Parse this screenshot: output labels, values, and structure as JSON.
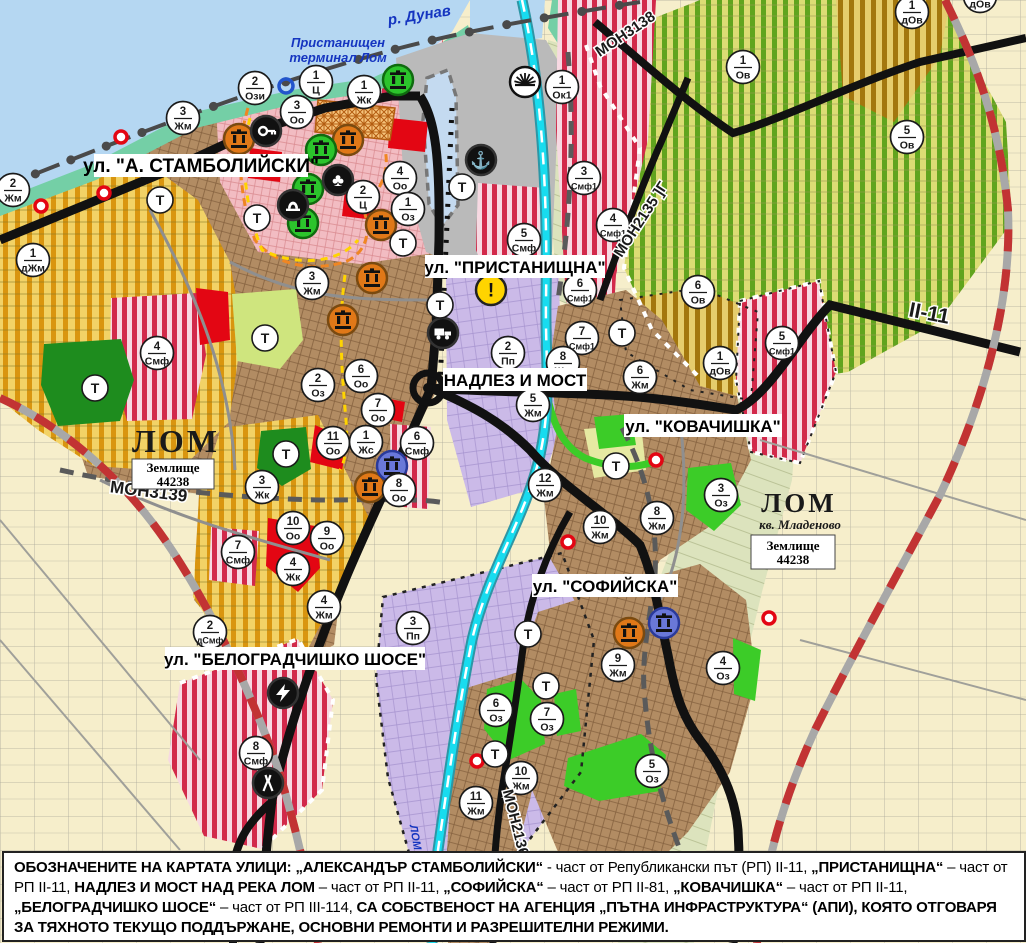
{
  "colors": {
    "water": "#b5d7f2",
    "shore_green": "#74cfa6",
    "port_gray": "#bababa",
    "harbor": "#c4daf0",
    "marker_bg": "#ffffff",
    "marker_ink": "#1a1a1a",
    "orange_icon": "#e07818",
    "green_icon": "#2cc42c",
    "blue_icon": "#6a78d8",
    "black_icon": "#111111",
    "warn_yellow": "#ffd400",
    "red_dot": "#e30613",
    "river_cyan": "#18dcef",
    "road_black": "#111111",
    "rail_red": "#c23333",
    "label_blue": "#1535c0"
  },
  "water_labels": [
    {
      "text": "р. Дунав",
      "x": 420,
      "y": 20,
      "rot": -9,
      "fs": 15
    },
    {
      "text": "Пристанищен",
      "x": 338,
      "y": 47,
      "rot": 0,
      "fs": 13
    },
    {
      "text": "терминал Лом",
      "x": 338,
      "y": 62,
      "rot": 0,
      "fs": 13
    },
    {
      "text": "ЛОМ",
      "x": 412,
      "y": 838,
      "rot": 80,
      "fs": 11
    }
  ],
  "street_labels": [
    {
      "text": "ул. \"А. СТАМБОЛИЙСКИ\"",
      "x": 201,
      "y": 166,
      "w": 214,
      "fs": 19
    },
    {
      "text": "ул. \"ПРИСТАНИЩНА\"",
      "x": 515,
      "y": 267,
      "w": 180,
      "fs": 17
    },
    {
      "text": "НАДЛЕЗ И МОСТ",
      "x": 515,
      "y": 380,
      "w": 144,
      "fs": 17
    },
    {
      "text": "ул. \"КОВАЧИШКА\"",
      "x": 703,
      "y": 426,
      "w": 158,
      "fs": 17
    },
    {
      "text": "ул. \"СОФИЙСКА\"",
      "x": 605,
      "y": 586,
      "w": 146,
      "fs": 17
    },
    {
      "text": "ул. \"БЕЛОГРАДЧИШКО ШОСЕ\"",
      "x": 295,
      "y": 659,
      "w": 260,
      "fs": 17
    }
  ],
  "road_labels": [
    {
      "text": "МОН3139",
      "x": 148,
      "y": 497,
      "rot": 7,
      "fs": 17
    },
    {
      "text": "МОН3138",
      "x": 628,
      "y": 38,
      "rot": -34,
      "fs": 15
    },
    {
      "text": "МОН2135 ]Г",
      "x": 645,
      "y": 222,
      "rot": -57,
      "fs": 15
    },
    {
      "text": "II-11",
      "x": 928,
      "y": 320,
      "rot": 11,
      "fs": 21
    },
    {
      "text": "МОН2136",
      "x": 511,
      "y": 824,
      "rot": 76,
      "fs": 15
    }
  ],
  "place_labels": {
    "lom1": {
      "text": "ЛОМ",
      "x": 176,
      "y": 452,
      "fs": 32
    },
    "lom2": {
      "text": "ЛОМ",
      "x": 799,
      "y": 512,
      "fs": 27
    },
    "mladenovo": {
      "text": "кв. Младеново",
      "x": 800,
      "y": 529,
      "fs": 13
    },
    "zem1": {
      "line1": "Землище",
      "line2": "44238",
      "x": 173,
      "y": 474,
      "w": 82,
      "h": 30
    },
    "zem2": {
      "line1": "Землище",
      "line2": "44238",
      "x": 793,
      "y": 552,
      "w": 84,
      "h": 34
    }
  },
  "zone_markers": [
    {
      "n": "2",
      "c": "Жм",
      "x": 13,
      "y": 190
    },
    {
      "n": "3",
      "c": "Жм",
      "x": 183,
      "y": 118
    },
    {
      "n": "2",
      "c": "Ози",
      "x": 255,
      "y": 88
    },
    {
      "n": "1",
      "c": "Ц",
      "x": 316,
      "y": 82
    },
    {
      "n": "1",
      "c": "Жк",
      "x": 364,
      "y": 92
    },
    {
      "n": "3",
      "c": "Оо",
      "x": 297,
      "y": 112
    },
    {
      "n": "4",
      "c": "Оо",
      "x": 400,
      "y": 178
    },
    {
      "n": "2",
      "c": "Ц",
      "x": 363,
      "y": 197
    },
    {
      "n": "1",
      "c": "Оз",
      "x": 408,
      "y": 209
    },
    {
      "n": "1",
      "c": "Ок1",
      "x": 562,
      "y": 87
    },
    {
      "n": "3",
      "c": "Смф1",
      "x": 584,
      "y": 178
    },
    {
      "n": "4",
      "c": "Смф1",
      "x": 613,
      "y": 225
    },
    {
      "n": "5",
      "c": "Смф",
      "x": 524,
      "y": 240
    },
    {
      "n": "1",
      "c": "Ов",
      "x": 743,
      "y": 67
    },
    {
      "n": "5",
      "c": "Ов",
      "x": 907,
      "y": 137
    },
    {
      "n": "1",
      "c": "дОв",
      "x": 912,
      "y": 12
    },
    {
      "n": "1",
      "c": "дОв",
      "x": 980,
      "y": -4
    },
    {
      "n": "6",
      "c": "Ов",
      "x": 698,
      "y": 292
    },
    {
      "n": "1",
      "c": "дОв",
      "x": 720,
      "y": 363
    },
    {
      "n": "5",
      "c": "Смф1",
      "x": 782,
      "y": 343
    },
    {
      "n": "6",
      "c": "Смф1",
      "x": 580,
      "y": 290
    },
    {
      "n": "7",
      "c": "Смф1",
      "x": 582,
      "y": 338
    },
    {
      "n": "1",
      "c": "дЖм",
      "x": 33,
      "y": 260
    },
    {
      "n": "3",
      "c": "Жм",
      "x": 312,
      "y": 283
    },
    {
      "n": "4",
      "c": "Смф",
      "x": 157,
      "y": 353
    },
    {
      "n": "2",
      "c": "Оз",
      "x": 318,
      "y": 385
    },
    {
      "n": "6",
      "c": "Оо",
      "x": 361,
      "y": 376
    },
    {
      "n": "7",
      "c": "Оо",
      "x": 378,
      "y": 410
    },
    {
      "n": "11",
      "c": "Оо",
      "x": 333,
      "y": 443
    },
    {
      "n": "1",
      "c": "Жс",
      "x": 366,
      "y": 442
    },
    {
      "n": "6",
      "c": "Смф",
      "x": 417,
      "y": 443
    },
    {
      "n": "8",
      "c": "Оо",
      "x": 399,
      "y": 490
    },
    {
      "n": "3",
      "c": "Жк",
      "x": 262,
      "y": 487
    },
    {
      "n": "2",
      "c": "Пп",
      "x": 508,
      "y": 353
    },
    {
      "n": "8",
      "c": "Жм",
      "x": 563,
      "y": 363
    },
    {
      "n": "5",
      "c": "Жм",
      "x": 533,
      "y": 405
    },
    {
      "n": "6",
      "c": "Жм",
      "x": 640,
      "y": 377
    },
    {
      "n": "12",
      "c": "Жм",
      "x": 545,
      "y": 485
    },
    {
      "n": "10",
      "c": "Жм",
      "x": 600,
      "y": 527
    },
    {
      "n": "8",
      "c": "Жм",
      "x": 657,
      "y": 518
    },
    {
      "n": "3",
      "c": "Оз",
      "x": 721,
      "y": 495
    },
    {
      "n": "10",
      "c": "Оо",
      "x": 293,
      "y": 528
    },
    {
      "n": "9",
      "c": "Оо",
      "x": 327,
      "y": 538
    },
    {
      "n": "4",
      "c": "Жк",
      "x": 293,
      "y": 569
    },
    {
      "n": "4",
      "c": "Жм",
      "x": 324,
      "y": 607
    },
    {
      "n": "7",
      "c": "Смф",
      "x": 238,
      "y": 552
    },
    {
      "n": "2",
      "c": "дСмф",
      "x": 210,
      "y": 632
    },
    {
      "n": "3",
      "c": "Пп",
      "x": 413,
      "y": 628
    },
    {
      "n": "8",
      "c": "Смф",
      "x": 256,
      "y": 753
    },
    {
      "n": "9",
      "c": "Жм",
      "x": 618,
      "y": 665
    },
    {
      "n": "4",
      "c": "Оз",
      "x": 723,
      "y": 668
    },
    {
      "n": "6",
      "c": "Оз",
      "x": 496,
      "y": 710
    },
    {
      "n": "7",
      "c": "Оз",
      "x": 547,
      "y": 719
    },
    {
      "n": "5",
      "c": "Оз",
      "x": 652,
      "y": 771
    },
    {
      "n": "10",
      "c": "Жм",
      "x": 521,
      "y": 778
    },
    {
      "n": "11",
      "c": "Жм",
      "x": 476,
      "y": 803
    }
  ],
  "t_markers": [
    {
      "x": 160,
      "y": 200
    },
    {
      "x": 257,
      "y": 218
    },
    {
      "x": 462,
      "y": 187
    },
    {
      "x": 403,
      "y": 243
    },
    {
      "x": 440,
      "y": 305
    },
    {
      "x": 265,
      "y": 338
    },
    {
      "x": 95,
      "y": 388
    },
    {
      "x": 286,
      "y": 454
    },
    {
      "x": 622,
      "y": 333
    },
    {
      "x": 616,
      "y": 466
    },
    {
      "x": 528,
      "y": 634
    },
    {
      "x": 546,
      "y": 686
    },
    {
      "x": 495,
      "y": 754
    }
  ],
  "icons": [
    {
      "t": "monument-orange-icon",
      "x": 239,
      "y": 139
    },
    {
      "t": "monument-orange-icon",
      "x": 348,
      "y": 140
    },
    {
      "t": "monument-orange-icon",
      "x": 381,
      "y": 225
    },
    {
      "t": "monument-orange-icon",
      "x": 372,
      "y": 278
    },
    {
      "t": "monument-orange-icon",
      "x": 343,
      "y": 320
    },
    {
      "t": "monument-orange-icon",
      "x": 370,
      "y": 487
    },
    {
      "t": "monument-orange-icon",
      "x": 629,
      "y": 633
    },
    {
      "t": "monument-green-icon",
      "x": 398,
      "y": 80
    },
    {
      "t": "monument-green-icon",
      "x": 321,
      "y": 150
    },
    {
      "t": "monument-green-icon",
      "x": 308,
      "y": 189
    },
    {
      "t": "monument-green-icon",
      "x": 303,
      "y": 223
    },
    {
      "t": "monument-blue-icon",
      "x": 392,
      "y": 466
    },
    {
      "t": "monument-blue-icon",
      "x": 664,
      "y": 623
    },
    {
      "t": "key-icon",
      "x": 266,
      "y": 131
    },
    {
      "t": "club-icon",
      "x": 338,
      "y": 180
    },
    {
      "t": "arch-icon",
      "x": 293,
      "y": 205
    },
    {
      "t": "anchor-icon",
      "x": 481,
      "y": 160
    },
    {
      "t": "truck-icon",
      "x": 443,
      "y": 333
    },
    {
      "t": "lightning-icon",
      "x": 283,
      "y": 693
    },
    {
      "t": "road-fork-icon",
      "x": 268,
      "y": 783
    },
    {
      "t": "sun-icon",
      "x": 525,
      "y": 82
    },
    {
      "t": "warning-icon",
      "x": 491,
      "y": 290
    },
    {
      "t": "blue-ring-icon",
      "x": 286,
      "y": 86
    }
  ],
  "red_dots": [
    {
      "x": 121,
      "y": 137
    },
    {
      "x": 104,
      "y": 193
    },
    {
      "x": 41,
      "y": 206
    },
    {
      "x": 568,
      "y": 542
    },
    {
      "x": 656,
      "y": 460
    },
    {
      "x": 769,
      "y": 618
    },
    {
      "x": 477,
      "y": 761
    },
    {
      "x": 379,
      "y": 892
    }
  ],
  "legend": {
    "segments": [
      {
        "b": 1,
        "t": "ОБОЗНАЧЕНИТЕ НА КАРТАТА УЛИЦИ: „АЛЕКСАНДЪР СТАМБОЛИЙСКИ“"
      },
      {
        "b": 0,
        "t": " - част от Републикански път (РП) II-11, "
      },
      {
        "b": 1,
        "t": "„ПРИСТАНИЩНА“"
      },
      {
        "b": 0,
        "t": " – част от РП II-11, "
      },
      {
        "b": 1,
        "t": "НАДЛЕЗ И МОСТ НАД РЕКА ЛОМ"
      },
      {
        "b": 0,
        "t": " – част от РП II-11, "
      },
      {
        "b": 1,
        "t": "„СОФИЙСКА“"
      },
      {
        "b": 0,
        "t": " – част от РП II-81, "
      },
      {
        "b": 1,
        "t": "„КОВАЧИШКА“"
      },
      {
        "b": 0,
        "t": " – част от РП II-11, "
      },
      {
        "b": 1,
        "t": "„БЕЛОГРАДЧИШКО ШОСЕ“"
      },
      {
        "b": 0,
        "t": " – част от РП III-114, "
      },
      {
        "b": 1,
        "t": "СА СОБСТВЕНОСТ НА АГЕНЦИЯ „ПЪТНА ИНФРАСТРУКТУРА“ (АПИ), КОЯТО ОТГОВАРЯ ЗА ТЯХНОТО ТЕКУЩО ПОДДЪРЖАНЕ, ОСНОВНИ РЕМОНТИ И РАЗРЕШИТЕЛНИ РЕЖИМИ."
      }
    ]
  }
}
